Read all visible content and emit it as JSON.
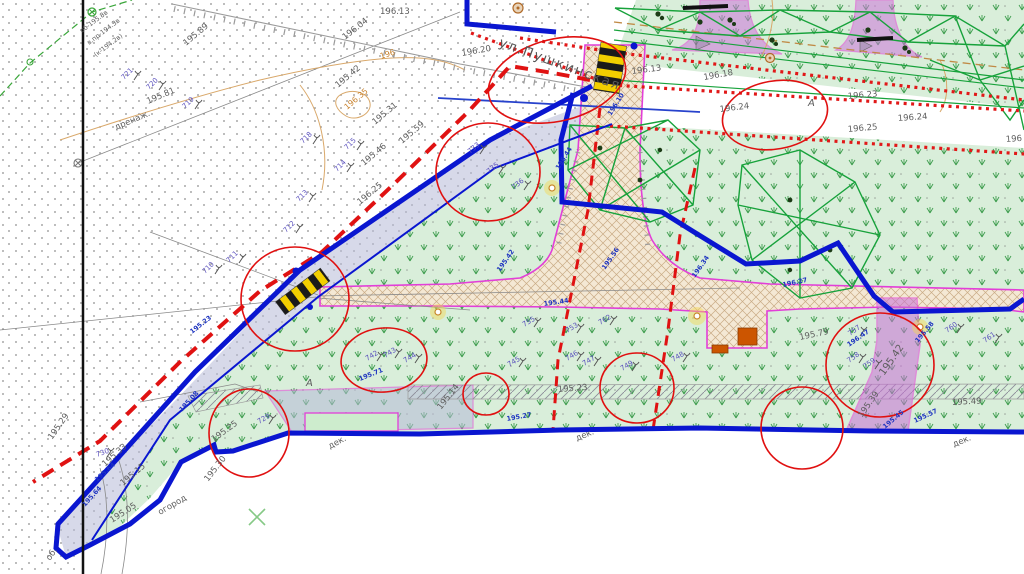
{
  "map_type": "topographic-site-plan",
  "street": {
    "name": "ул.Пушкинская",
    "x": 498,
    "y": 46,
    "rot": 20
  },
  "labels": {
    "gray": [
      {
        "t": "195.89",
        "x": 186,
        "y": 46,
        "r": -40
      },
      {
        "t": "196.04",
        "x": 345,
        "y": 40,
        "r": -38
      },
      {
        "t": "196.13",
        "x": 380,
        "y": 14,
        "r": 0
      },
      {
        "t": "196.20",
        "x": 462,
        "y": 56,
        "r": -10
      },
      {
        "t": "196.13",
        "x": 632,
        "y": 74,
        "r": -7
      },
      {
        "t": "196.18",
        "x": 704,
        "y": 80,
        "r": -10
      },
      {
        "t": "196.23",
        "x": 848,
        "y": 99,
        "r": -5
      },
      {
        "t": "196.24",
        "x": 898,
        "y": 121,
        "r": -4
      },
      {
        "t": "196.24",
        "x": 720,
        "y": 112,
        "r": -7
      },
      {
        "t": "196.25",
        "x": 848,
        "y": 132,
        "r": -5
      },
      {
        "t": "196",
        "x": 1006,
        "y": 142,
        "r": -4
      },
      {
        "t": "195.42",
        "x": 338,
        "y": 88,
        "r": -40
      },
      {
        "t": "195.31",
        "x": 375,
        "y": 125,
        "r": -40
      },
      {
        "t": "195.59",
        "x": 402,
        "y": 144,
        "r": -40
      },
      {
        "t": "195.46",
        "x": 364,
        "y": 166,
        "r": -40
      },
      {
        "t": "196.25",
        "x": 360,
        "y": 205,
        "r": -40
      },
      {
        "t": "195.29",
        "x": 52,
        "y": 440,
        "r": -55
      },
      {
        "t": "195.05",
        "x": 112,
        "y": 523,
        "r": -33
      },
      {
        "t": "огород",
        "x": 160,
        "y": 515,
        "r": -30
      },
      {
        "t": "195.15",
        "x": 123,
        "y": 486,
        "r": -40
      },
      {
        "t": "195.33",
        "x": 105,
        "y": 467,
        "r": -42
      },
      {
        "t": "195.30",
        "x": 208,
        "y": 482,
        "r": -52
      },
      {
        "t": "195.25",
        "x": 214,
        "y": 442,
        "r": -36
      },
      {
        "t": "195.79",
        "x": 800,
        "y": 340,
        "r": -12
      },
      {
        "t": "195.49",
        "x": 952,
        "y": 405,
        "r": -3
      },
      {
        "t": "195.42",
        "x": 884,
        "y": 376,
        "r": -55,
        "fs": 10
      },
      {
        "t": "195.39",
        "x": 862,
        "y": 418,
        "r": -55
      },
      {
        "t": "195.23",
        "x": 558,
        "y": 392,
        "r": -4
      },
      {
        "t": "195.14",
        "x": 441,
        "y": 410,
        "r": -52
      },
      {
        "t": "дек.",
        "x": 330,
        "y": 449,
        "r": -28
      },
      {
        "t": "дек.",
        "x": 577,
        "y": 441,
        "r": -22
      },
      {
        "t": "дек.",
        "x": 954,
        "y": 447,
        "r": -22
      },
      {
        "t": "об.",
        "x": 50,
        "y": 561,
        "r": -55
      },
      {
        "t": "195.81",
        "x": 148,
        "y": 104,
        "r": -23
      },
      {
        "t": "дренаж.",
        "x": 116,
        "y": 130,
        "r": -23
      },
      {
        "t": "А",
        "x": 306,
        "y": 386,
        "r": 0,
        "fs": 10,
        "it": true
      },
      {
        "t": "А",
        "x": 808,
        "y": 106,
        "r": 0,
        "fs": 10,
        "it": true
      }
    ],
    "utility_note": [
      {
        "t": "об-195.8в",
        "x": 82,
        "y": 33,
        "r": -37
      },
      {
        "t": "в.пр-194.3в",
        "x": 89,
        "y": 45,
        "r": -37
      },
      {
        "t": "(к-194.2в)",
        "x": 96,
        "y": 57,
        "r": -37
      }
    ],
    "blue": [
      {
        "t": "195.23",
        "x": 192,
        "y": 334,
        "r": -38
      },
      {
        "t": "195.42",
        "x": 500,
        "y": 272,
        "r": -55
      },
      {
        "t": "195.56",
        "x": 605,
        "y": 270,
        "r": -55
      },
      {
        "t": "196.34",
        "x": 695,
        "y": 278,
        "r": -55
      },
      {
        "t": "196.44",
        "x": 559,
        "y": 170,
        "r": -58
      },
      {
        "t": "196.10",
        "x": 611,
        "y": 116,
        "r": -58
      },
      {
        "t": "196.47",
        "x": 849,
        "y": 347,
        "r": -35
      },
      {
        "t": "195.58",
        "x": 918,
        "y": 343,
        "r": -50
      },
      {
        "t": "195.45",
        "x": 885,
        "y": 429,
        "r": -40
      },
      {
        "t": "195.57",
        "x": 915,
        "y": 423,
        "r": -25
      },
      {
        "t": "195.27",
        "x": 507,
        "y": 421,
        "r": -10
      },
      {
        "t": "195.44",
        "x": 544,
        "y": 306,
        "r": -8
      },
      {
        "t": "195.71",
        "x": 360,
        "y": 381,
        "r": -22
      },
      {
        "t": "195.08",
        "x": 182,
        "y": 412,
        "r": -48
      },
      {
        "t": "195.64",
        "x": 97,
        "y": 482,
        "r": -42
      },
      {
        "t": "195.64",
        "x": 85,
        "y": 507,
        "r": -48
      },
      {
        "t": "196.27",
        "x": 783,
        "y": 287,
        "r": -12
      }
    ],
    "orange": [
      {
        "t": "196",
        "x": 381,
        "y": 59,
        "r": -18
      },
      {
        "t": "196.35",
        "x": 347,
        "y": 110,
        "r": -40
      }
    ],
    "tree_numbers": [
      {
        "t": "721",
        "x": 124,
        "y": 80,
        "r": -45
      },
      {
        "t": "720",
        "x": 149,
        "y": 90,
        "r": -45
      },
      {
        "t": "719",
        "x": 185,
        "y": 109,
        "r": -45
      },
      {
        "t": "718",
        "x": 303,
        "y": 144,
        "r": -45
      },
      {
        "t": "715",
        "x": 347,
        "y": 150,
        "r": -45
      },
      {
        "t": "714",
        "x": 337,
        "y": 172,
        "r": -45
      },
      {
        "t": "713",
        "x": 299,
        "y": 202,
        "r": -45
      },
      {
        "t": "712",
        "x": 286,
        "y": 233,
        "r": -45
      },
      {
        "t": "711",
        "x": 229,
        "y": 263,
        "r": -45
      },
      {
        "t": "710",
        "x": 205,
        "y": 274,
        "r": -45
      },
      {
        "t": "733",
        "x": 470,
        "y": 154,
        "r": -40
      },
      {
        "t": "735",
        "x": 489,
        "y": 174,
        "r": -40
      },
      {
        "t": "736",
        "x": 514,
        "y": 190,
        "r": -40
      },
      {
        "t": "729",
        "x": 259,
        "y": 424,
        "r": -30
      },
      {
        "t": "730",
        "x": 97,
        "y": 457,
        "r": -20
      },
      {
        "t": "742",
        "x": 367,
        "y": 361,
        "r": -30
      },
      {
        "t": "743",
        "x": 385,
        "y": 358,
        "r": -30
      },
      {
        "t": "744",
        "x": 405,
        "y": 363,
        "r": -30
      },
      {
        "t": "745",
        "x": 509,
        "y": 367,
        "r": -30
      },
      {
        "t": "746",
        "x": 567,
        "y": 361,
        "r": -30
      },
      {
        "t": "747",
        "x": 584,
        "y": 366,
        "r": -30
      },
      {
        "t": "748",
        "x": 673,
        "y": 362,
        "r": -30
      },
      {
        "t": "749",
        "x": 622,
        "y": 371,
        "r": -30
      },
      {
        "t": "753",
        "x": 567,
        "y": 333,
        "r": -30
      },
      {
        "t": "755",
        "x": 524,
        "y": 327,
        "r": -30
      },
      {
        "t": "762",
        "x": 600,
        "y": 325,
        "r": -30
      },
      {
        "t": "757",
        "x": 850,
        "y": 336,
        "r": -35
      },
      {
        "t": "758",
        "x": 849,
        "y": 363,
        "r": -35
      },
      {
        "t": "759",
        "x": 865,
        "y": 369,
        "r": -35
      },
      {
        "t": "760",
        "x": 947,
        "y": 333,
        "r": -35
      },
      {
        "t": "761",
        "x": 985,
        "y": 343,
        "r": -35
      }
    ]
  },
  "icons": [
    "pedestrian-crossing-icon",
    "manhole-icon",
    "lamp-icon",
    "bench-icon",
    "tree-icon",
    "tree-canopy-icon",
    "survey-cross-icon"
  ],
  "colors": {
    "boundary_blue": "#0a16d0",
    "red_line": "#e01212",
    "red_dotted": "#e11818",
    "path_magenta": "#e23fd8",
    "canopy_green": "#17a23b",
    "park_green": "#d9eeda",
    "road_lavender": "#b6bad7",
    "crosswalk_yellow": "#f2cf00",
    "contour_tan": "#d9a86a",
    "label_gray": "#5d5d5d",
    "label_blue": "#1f35c0",
    "tree_number_violet": "#5a50bd"
  }
}
